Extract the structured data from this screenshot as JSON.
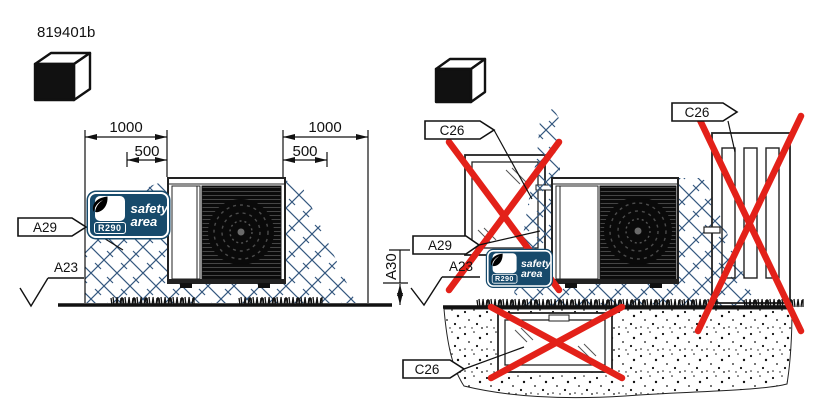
{
  "document": {
    "title": "819401b"
  },
  "badge": {
    "refrigerant": "R290",
    "line1": "safety",
    "line2": "area"
  },
  "left_view": {
    "dim_outer": "1000",
    "dim_inner": "500",
    "label_height": "A30",
    "label_area": "A29",
    "label_ground": "A23"
  },
  "right_view": {
    "label_area": "A29",
    "label_ground": "A23",
    "label_opening": "C26"
  },
  "colors": {
    "line": "#1a1a1a",
    "hatch_blue": "#35587f",
    "cross_red": "#e32119",
    "badge_navy": "#174a6b",
    "badge_text": "#ffffff"
  },
  "icons": {
    "cube": "isometric-cube",
    "leaf": "r290-leaf",
    "cross": "prohibited-cross",
    "ground_symbol": "surface-level-check"
  }
}
